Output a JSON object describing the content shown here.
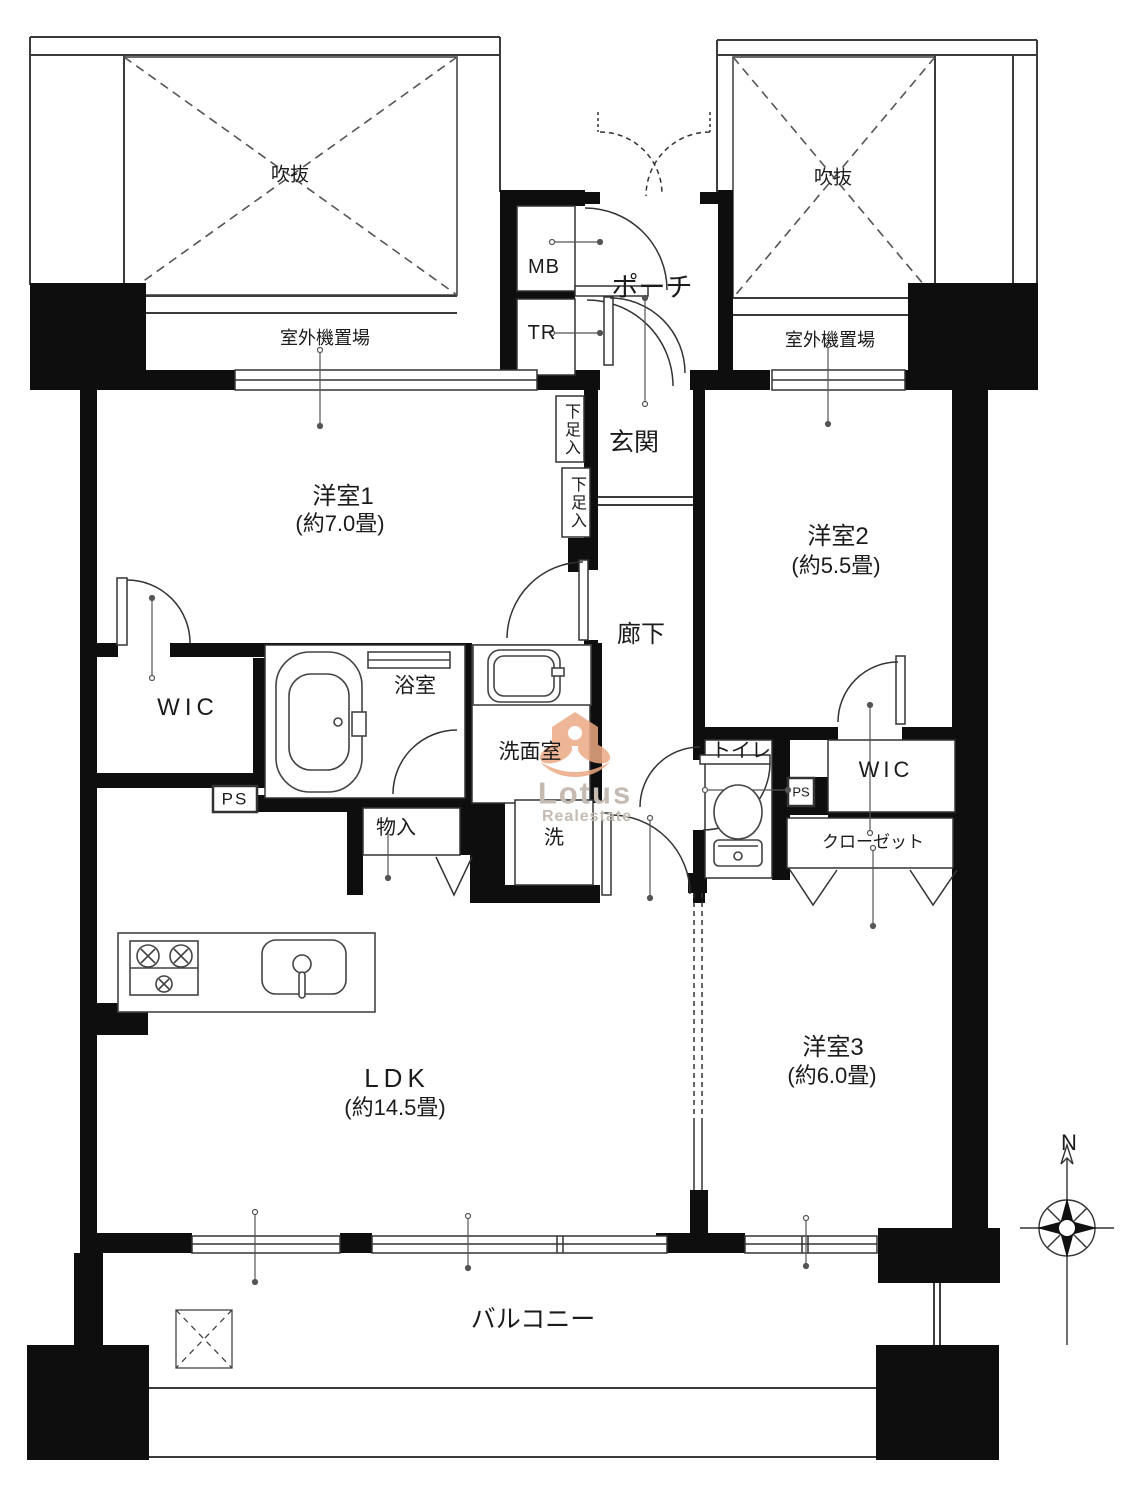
{
  "exterior": {
    "void_left": "吹抜",
    "void_right": "吹抜",
    "outdoor_unit_left": "室外機置場",
    "outdoor_unit_right": "室外機置場",
    "mb": "MB",
    "tr": "TR",
    "porch": "ポーチ",
    "balcony": "バルコニー"
  },
  "rooms": {
    "entrance": "玄関",
    "hallway": "廊下",
    "room1": {
      "name": "洋室1",
      "size": "(約7.0畳)"
    },
    "room2": {
      "name": "洋室2",
      "size": "(約5.5畳)"
    },
    "room3": {
      "name": "洋室3",
      "size": "(約6.0畳)"
    },
    "ldk": {
      "name": "LDK",
      "size": "(約14.5畳)"
    },
    "bathroom": "浴室",
    "washroom": "洗面室",
    "toilet": "トイレ"
  },
  "storage": {
    "wic_left": "WIC",
    "wic_right": "WIC",
    "closet": "クローゼット",
    "shoe_upper": "下足入",
    "shoe_lower": "下足入",
    "storage_small": "物入",
    "laundry": "洗",
    "ps_left": "PS",
    "ps_right": "PS"
  },
  "compass": {
    "north": "N"
  },
  "watermark": {
    "line1": "Lotus",
    "line2": "Realestate"
  },
  "colors": {
    "wall": "#0e0e0e",
    "line": "#3b3b3b",
    "watermark_orange": "#ecaa84"
  }
}
